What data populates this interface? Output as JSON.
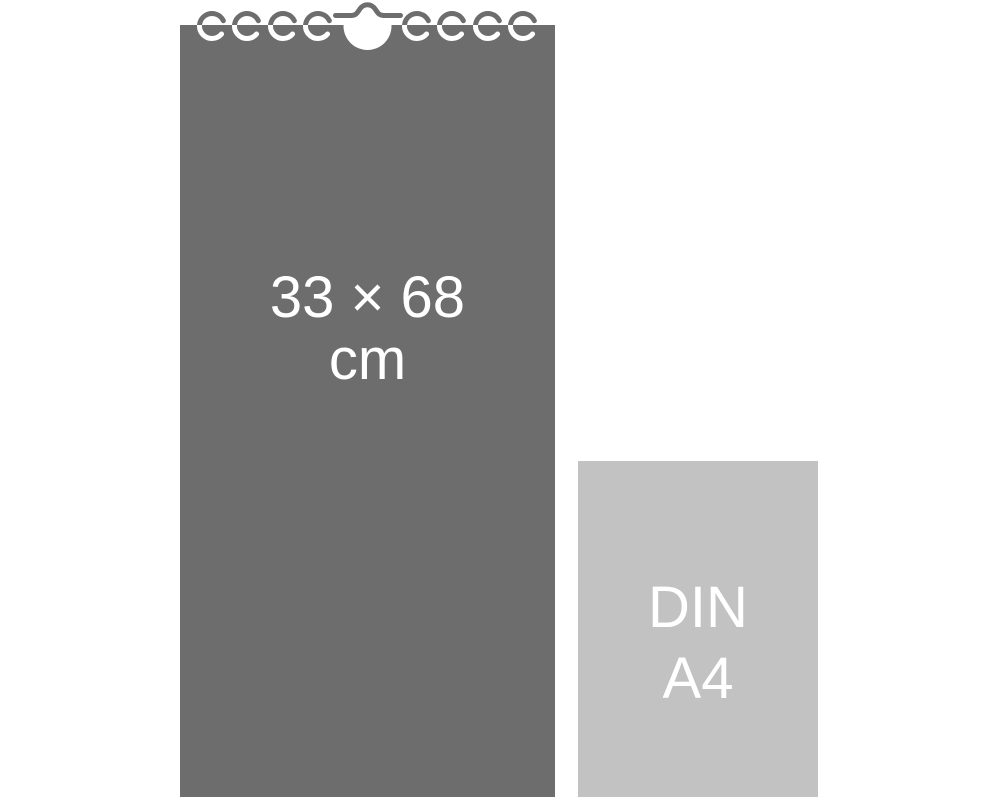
{
  "colors": {
    "page-bg": "#ffffff",
    "calendar-fill": "#6d6d6d",
    "a4-fill": "#c2c2c2",
    "label-text": "#ffffff"
  },
  "calendar": {
    "size_label": {
      "line1": "33 × 68",
      "line2": "cm"
    },
    "width_cm": "33",
    "height_cm": "68",
    "binding": {
      "ring_count": 8,
      "hanger": "center wall-hook with round cutout"
    }
  },
  "a4": {
    "label": {
      "line1": "DIN",
      "line2": "A4"
    }
  }
}
